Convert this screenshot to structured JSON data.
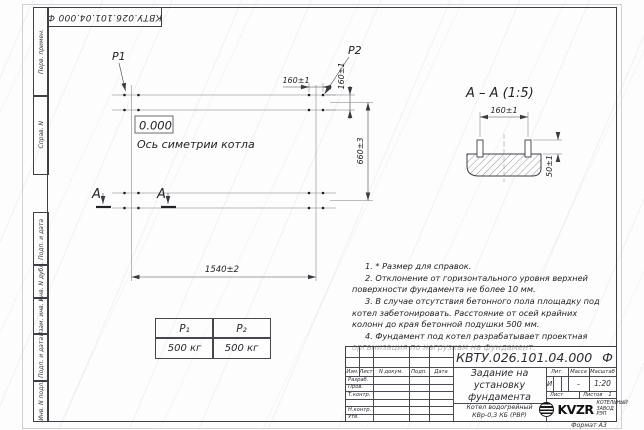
{
  "designation": "КВТУ.026.101.04.000 Ф",
  "margin_labels": [
    "Перв. примен.",
    "Справ. N",
    "Подп. и дата",
    "Инв. N дубл.",
    "Взам. инв. N",
    "Подп. и дата",
    "Инв. N подл."
  ],
  "plan": {
    "p1": "P1",
    "p2": "P2",
    "level": "0.000",
    "axis_label": "Ось симетрии котла",
    "dim_bolt_spacing_h": "160±1",
    "dim_bolt_spacing_v": "160±1",
    "dim_width": "660±3",
    "dim_length": "1540±2",
    "section_letter": "A"
  },
  "section_view": {
    "title": "А – А (1:5)",
    "dim_spacing": "160±1",
    "dim_height": "50±1"
  },
  "load_table": {
    "headers": [
      "P₁",
      "P₂"
    ],
    "values": [
      "500 кг",
      "500 кг"
    ]
  },
  "notes": [
    "1. * Размер для справок.",
    "2. Отклонение от горизонтального уровня верхней поверхности фундамента не более 10 мм.",
    "3. В случае отсутствия бетонного пола площадку под котел забетонировать. Расстояние от осей крайних колонн до края бетонной подушки 500 мм.",
    "4. Фундамент под котел разрабатывает проектная организация по нагрузкам на фундамент."
  ],
  "title_block": {
    "rev_cols": {
      "izm": "Изм.",
      "list": "Лист",
      "doc": "N докум.",
      "sign": "Подп.",
      "date": "Дата"
    },
    "sig_rows": [
      "Разраб.",
      "Пров.",
      "Т.контр.",
      "",
      "Н.контр.",
      "Утв."
    ],
    "doc_title": "Задание на установку фундамента",
    "product": "Котел водогрейный КВр-0,3 КБ (РВР)",
    "lit_label": "Лит.",
    "lit_value": "И",
    "mass_label": "Масса",
    "mass_value": "–",
    "scale_label": "Масштаб",
    "scale_value": "1:20",
    "sheet_label": "Лист",
    "sheets_label": "Листов",
    "sheets_value": "1",
    "logo_text": "KVZR",
    "company": "КОТЕЛЬНЫЙ ЗАВОД РЭП",
    "format_label": "Формат А3"
  }
}
